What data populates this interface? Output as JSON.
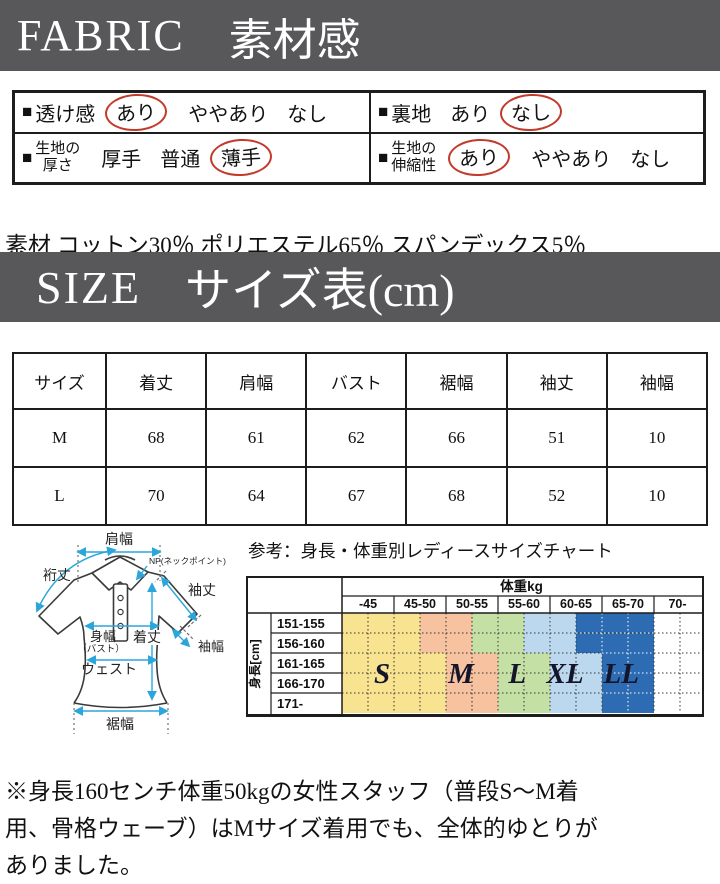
{
  "banners": {
    "fabric_en": "FABRIC",
    "fabric_ja": "素材感",
    "size_en": "SIZE",
    "size_ja": "サイズ表(cm)"
  },
  "fabric_table": {
    "bullet": "■",
    "cells": [
      {
        "label_lines": [
          "透け感"
        ],
        "options": [
          {
            "text": "あり",
            "circled": true
          },
          {
            "text": "ややあり",
            "circled": false
          },
          {
            "text": "なし",
            "circled": false
          }
        ]
      },
      {
        "label_lines": [
          "裏地"
        ],
        "options": [
          {
            "text": "あり",
            "circled": false
          },
          {
            "text": "なし",
            "circled": true
          }
        ]
      },
      {
        "label_lines": [
          "生地の",
          "厚さ"
        ],
        "options": [
          {
            "text": "厚手",
            "circled": false
          },
          {
            "text": "普通",
            "circled": false
          },
          {
            "text": "薄手",
            "circled": true
          }
        ]
      },
      {
        "label_lines": [
          "生地の",
          "伸縮性"
        ],
        "options": [
          {
            "text": "あり",
            "circled": true
          },
          {
            "text": "ややあり",
            "circled": false
          },
          {
            "text": "なし",
            "circled": false
          }
        ]
      }
    ]
  },
  "material_line": "素材 コットン30％ ポリエステル65％ スパンデックス5％",
  "size_table": {
    "headers": [
      "サイズ",
      "着丈",
      "肩幅",
      "バスト",
      "裾幅",
      "袖丈",
      "袖幅"
    ],
    "rows": [
      [
        "M",
        "68",
        "61",
        "62",
        "66",
        "51",
        "10"
      ],
      [
        "L",
        "70",
        "64",
        "67",
        "68",
        "52",
        "10"
      ]
    ]
  },
  "diagram": {
    "labels": {
      "shoulder": "肩幅",
      "yuki": "裄丈",
      "np": "NP(ネックポイント)",
      "sleeve_len": "袖丈",
      "sleeve_w": "袖幅",
      "body_w": "身幅",
      "bust": "（バスト）",
      "length": "着丈",
      "waist": "ウェスト",
      "hem": "裾幅"
    }
  },
  "chart_data": {
    "type": "heatmap",
    "title": "参考：身長・体重別レディースサイズチャート",
    "weight_header": "体重kg",
    "weight_cols": [
      "-45",
      "45-50",
      "50-55",
      "55-60",
      "60-65",
      "65-70",
      "70-"
    ],
    "height_header": "身長[cm]",
    "height_rows": [
      "151-155",
      "156-160",
      "161-165",
      "166-170",
      "171-"
    ],
    "sizes": [
      "S",
      "M",
      "L",
      "XL",
      "LL"
    ],
    "size_colors": [
      "#F8E391",
      "#F6C2A0",
      "#C5E0A5",
      "#BCD8EE",
      "#2D6CB2"
    ],
    "row_band_bounds": [
      [
        0,
        1.5,
        2.5,
        3.5,
        4.5,
        6
      ],
      [
        0,
        1.5,
        2.5,
        3.5,
        4.5,
        6
      ],
      [
        0,
        2,
        3,
        4,
        5,
        6
      ],
      [
        0,
        2,
        3,
        4,
        5,
        6
      ],
      [
        0,
        2,
        3,
        4,
        5,
        6
      ]
    ],
    "size_label_positions": [
      {
        "label": "S",
        "col": 0.77,
        "row": 3
      },
      {
        "label": "M",
        "col": 2.29,
        "row": 3
      },
      {
        "label": "L",
        "col": 3.37,
        "row": 3
      },
      {
        "label": "XL",
        "col": 4.29,
        "row": 3
      },
      {
        "label": "LL",
        "col": 5.37,
        "row": 3
      }
    ]
  },
  "note": "※身長160センチ体重50kgの女性スタッフ（普段S〜M着\n用、骨格ウェーブ）はMサイズ着用でも、全体的ゆとりが\nありました。"
}
